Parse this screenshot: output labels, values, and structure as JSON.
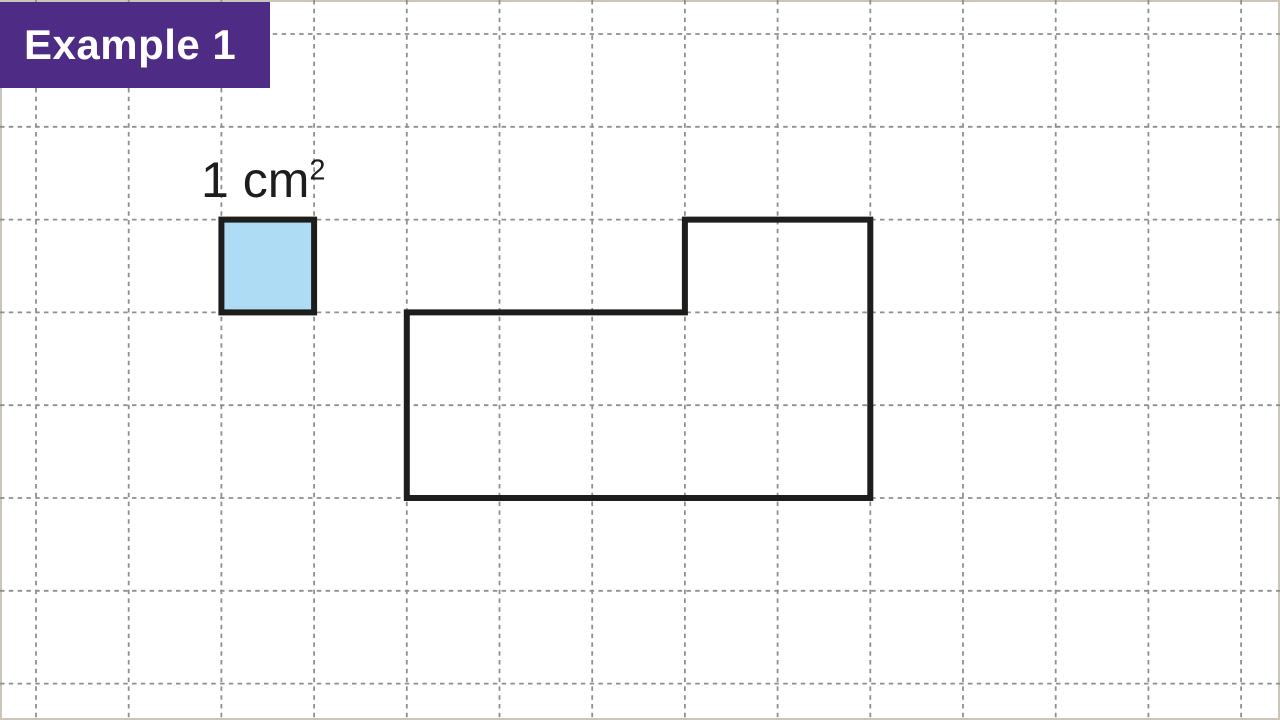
{
  "badge": {
    "label": "Example 1",
    "background": "#4e2c85",
    "text_color": "#ffffff"
  },
  "unit_label": {
    "text": "1 cm",
    "exponent": "2"
  },
  "colors": {
    "page_background": "#ffffff",
    "page_border": "#cbc4ba",
    "grid_line": "#8f8f8f",
    "shape_stroke": "#1d1d1b",
    "unit_square_fill": "#aedcf5"
  },
  "diagram": {
    "grid": {
      "origin_x": 36,
      "origin_y": 34,
      "cell_width": 92.7,
      "cell_height": 92.8,
      "line_width": 1.8,
      "dash": "4.5 4.3"
    },
    "unit_square": {
      "col": 2,
      "row": 2,
      "width_cells": 1,
      "height_cells": 1,
      "stroke_width": 6
    },
    "composite_shape": {
      "vertices_cells": [
        [
          4,
          3
        ],
        [
          7,
          3
        ],
        [
          7,
          2
        ],
        [
          9,
          2
        ],
        [
          9,
          5
        ],
        [
          4,
          5
        ]
      ],
      "stroke_width": 6,
      "fill": "none"
    }
  }
}
